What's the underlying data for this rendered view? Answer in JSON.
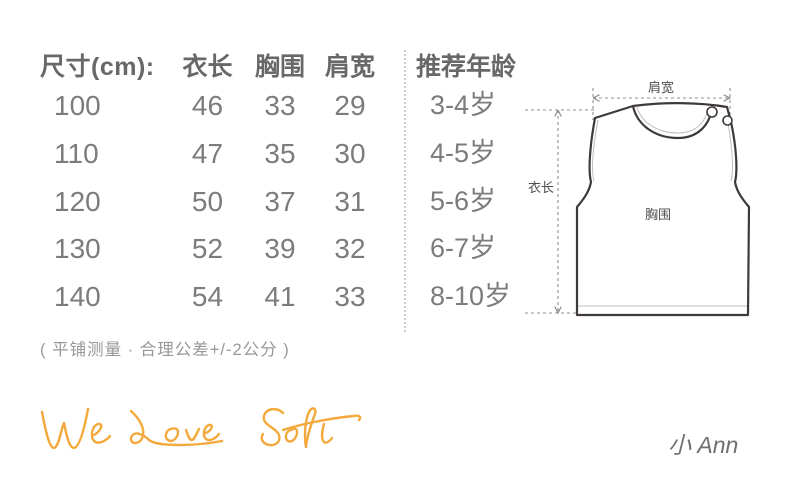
{
  "table": {
    "headers": {
      "size": "尺寸(cm):",
      "length": "衣长",
      "chest": "胸围",
      "shoulder": "肩宽",
      "age": "推荐年龄"
    },
    "rows": [
      {
        "size": "100",
        "length": "46",
        "chest": "33",
        "shoulder": "29",
        "age": "3-4岁"
      },
      {
        "size": "110",
        "length": "47",
        "chest": "35",
        "shoulder": "30",
        "age": "4-5岁"
      },
      {
        "size": "120",
        "length": "50",
        "chest": "37",
        "shoulder": "31",
        "age": "5-6岁"
      },
      {
        "size": "130",
        "length": "52",
        "chest": "39",
        "shoulder": "32",
        "age": "6-7岁"
      },
      {
        "size": "140",
        "length": "54",
        "chest": "41",
        "shoulder": "33",
        "age": "8-10岁"
      }
    ],
    "note": "( 平铺测量 · 合理公差+/-2公分 )"
  },
  "chart_data": {
    "type": "table",
    "columns": [
      "尺寸(cm)",
      "衣长",
      "胸围",
      "肩宽",
      "推荐年龄"
    ],
    "rows": [
      [
        "100",
        "46",
        "33",
        "29",
        "3-4岁"
      ],
      [
        "110",
        "47",
        "35",
        "30",
        "4-5岁"
      ],
      [
        "120",
        "50",
        "37",
        "31",
        "5-6岁"
      ],
      [
        "130",
        "52",
        "39",
        "32",
        "6-7岁"
      ],
      [
        "140",
        "54",
        "41",
        "33",
        "8-10岁"
      ]
    ],
    "note": "( 平铺测量 · 合理公差+/-2公分 )",
    "units": "cm"
  },
  "diagram": {
    "labels": {
      "shoulder": "肩宽",
      "length": "衣长",
      "chest": "胸围"
    }
  },
  "footer": {
    "slogan": "We Love Soft",
    "brand": "小 Ann"
  },
  "colors": {
    "header_text": "#67686a",
    "body_text": "#7b7c7e",
    "note_text": "#97989a",
    "accent": "#f3a93c",
    "vest_outline": "#3f393b",
    "dash_lines": "#8f8f8f"
  }
}
